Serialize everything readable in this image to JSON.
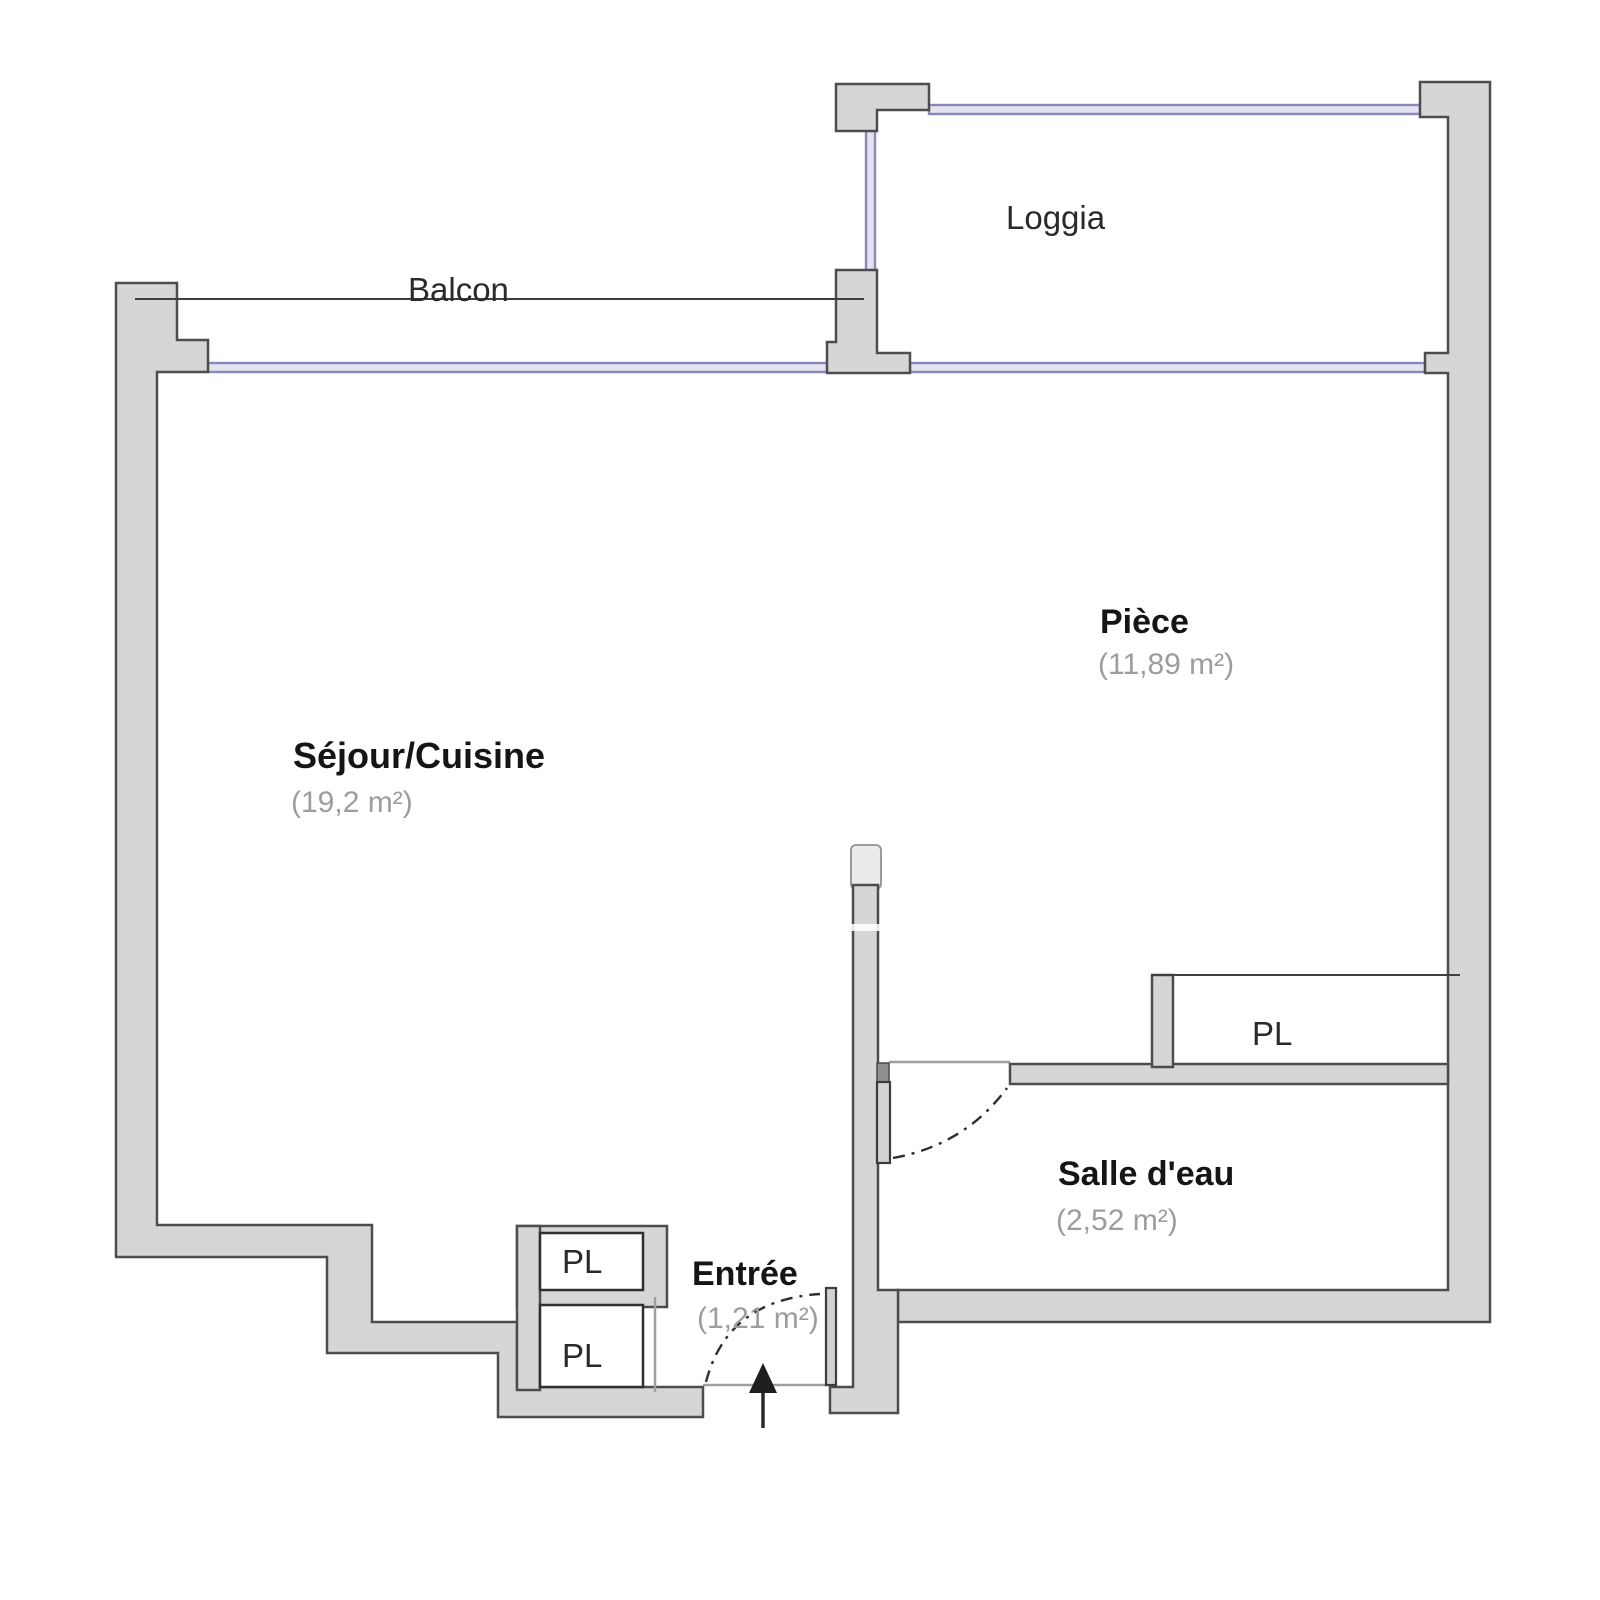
{
  "colors": {
    "wall_fill": "#d6d6d6",
    "wall_stroke": "#4d4d4d",
    "wall_faded": "#ebebeb",
    "window_dark": "#8a88ba",
    "window_light": "#e4e3f0",
    "muted": "#9d9d9d"
  },
  "labels": {
    "balcon": "Balcon",
    "loggia": "Loggia",
    "piece_name": "Pièce",
    "piece_area": "(11,89 m²)",
    "sejour_name": "Séjour/Cuisine",
    "sejour_area": "(19,2 m²)",
    "salle_name": "Salle d'eau",
    "salle_area": "(2,52 m²)",
    "entree_name": "Entrée",
    "entree_area": "(1,21 m²)",
    "pl_piece": "PL",
    "pl_upper": "PL",
    "pl_lower": "PL"
  }
}
